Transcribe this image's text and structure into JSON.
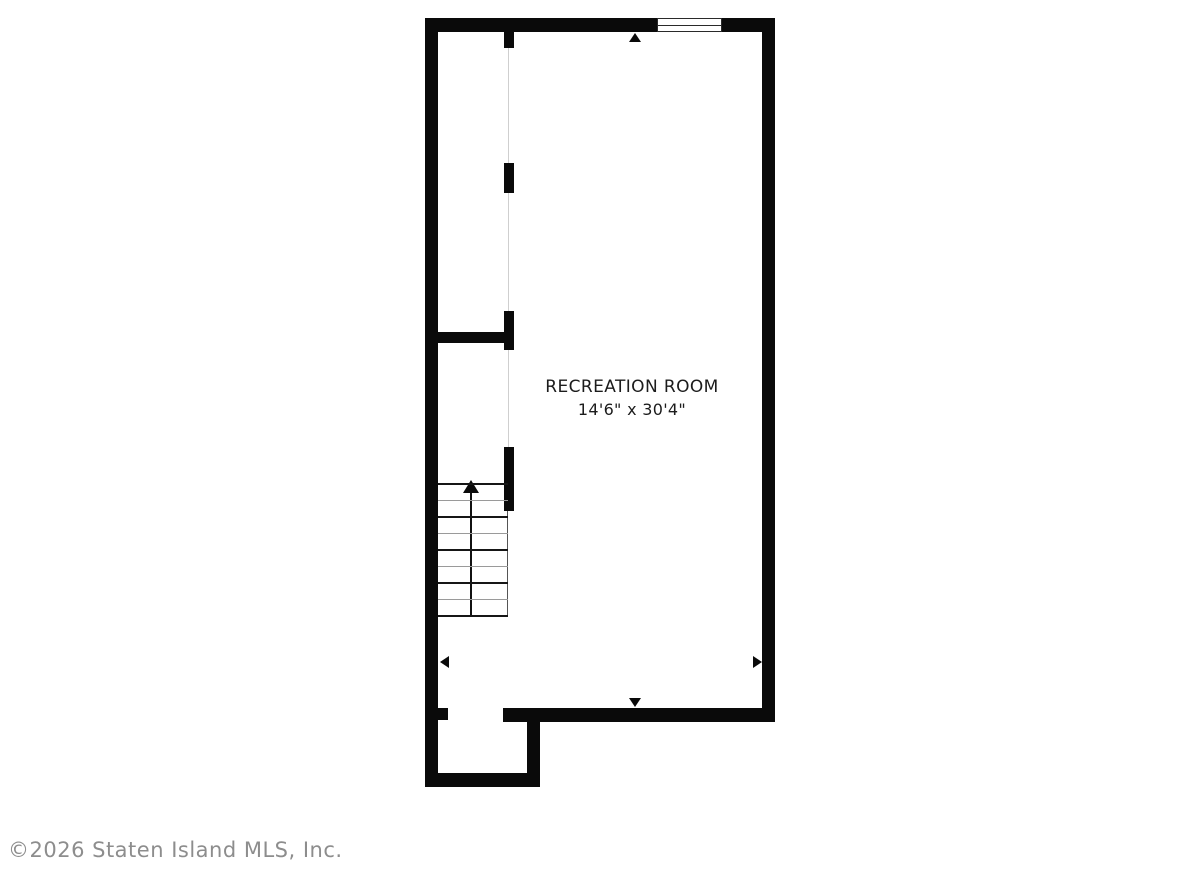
{
  "floorplan": {
    "room_label": "RECREATION ROOM",
    "room_dimensions": "14'6\" x 30'4\"",
    "copyright": "©2026 Staten Island MLS, Inc.",
    "stairs": {
      "treads": 9,
      "direction": "up"
    },
    "icons": {
      "window": "window-icon",
      "stairs_arrow": "stairs-up-arrow-icon",
      "dimension_arrows": [
        "dimension-arrow-up-icon",
        "dimension-arrow-down-icon",
        "dimension-arrow-left-icon",
        "dimension-arrow-right-icon"
      ]
    },
    "colors": {
      "wall": "#0a0a0a",
      "background": "#ffffff",
      "label_text": "#1c1c1c",
      "copyright_text": "#8d8d8d"
    }
  }
}
